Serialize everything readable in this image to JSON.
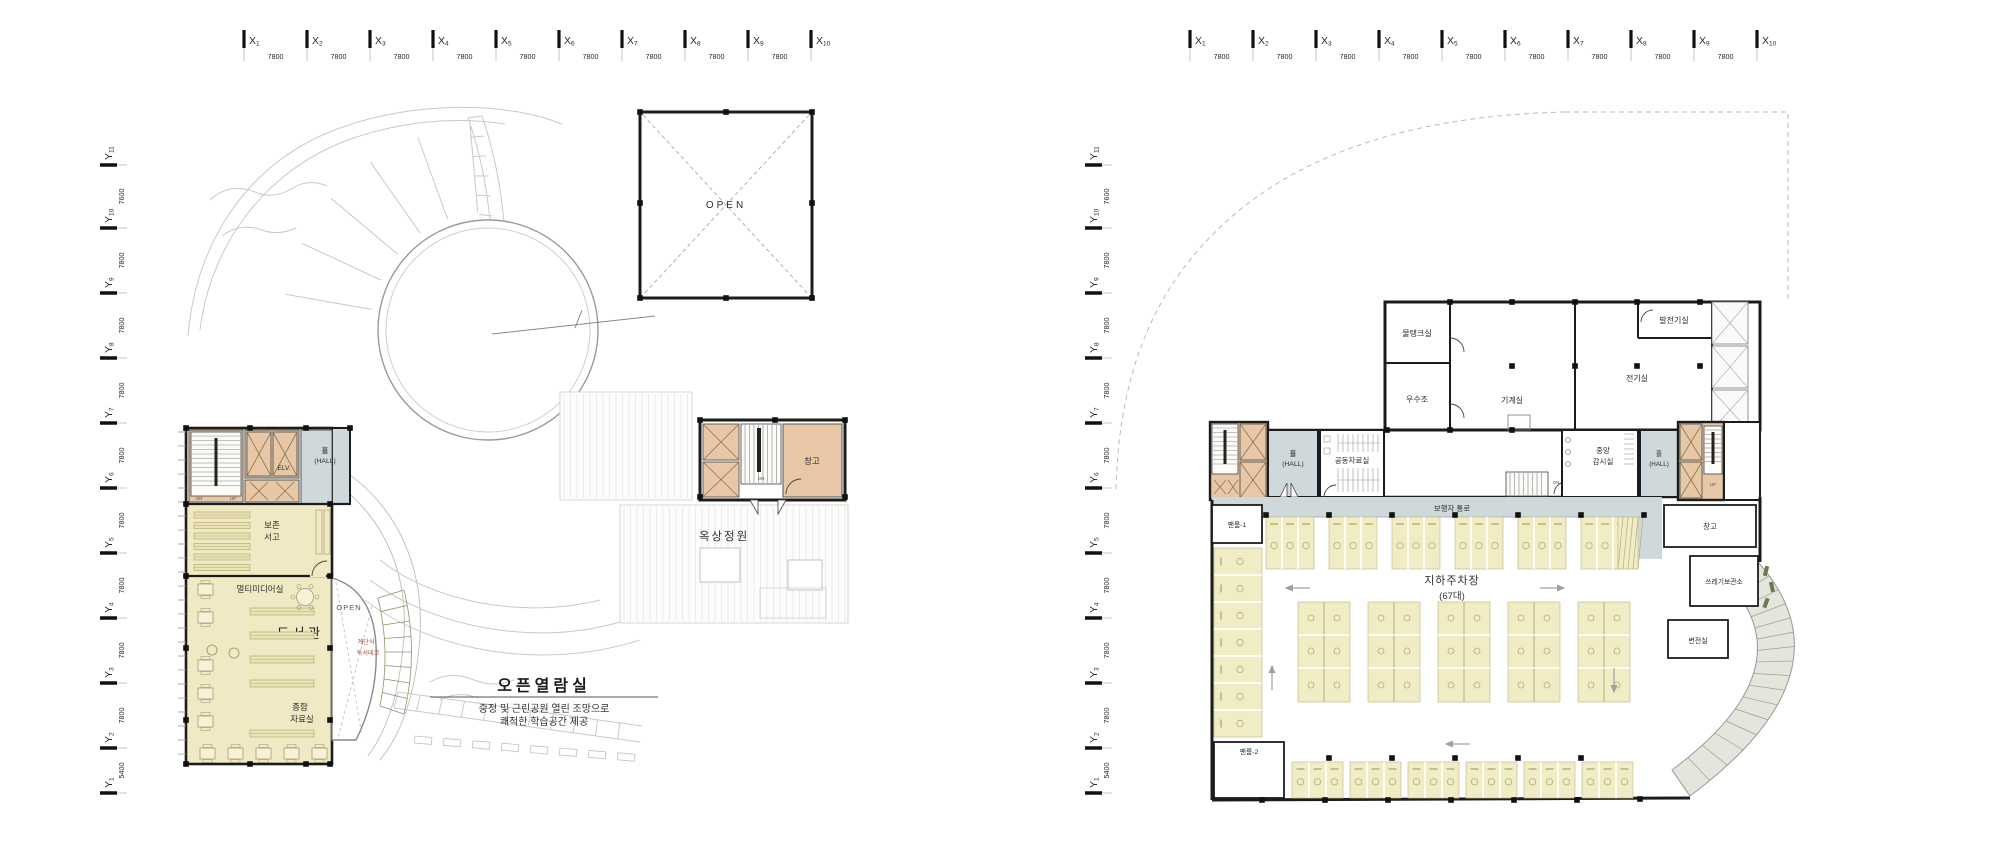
{
  "sheet": {
    "description": "Two Korean architectural floor plans side by side"
  },
  "colors": {
    "wall": "#1c1c1c",
    "core_fill": "#e7c7a5",
    "hall_fill": "#cfd8da",
    "room_yellow": "#efeac3",
    "stall_yellow": "#f0ecc6",
    "landscape_line": "#c9c9c9",
    "accent_text": "#9c4b32",
    "ramp_fill": "#e3e6dc"
  },
  "axes": {
    "x": {
      "base": "X",
      "numbers": [
        "1",
        "2",
        "3",
        "4",
        "5",
        "6",
        "7",
        "8",
        "9",
        "10"
      ],
      "spacing": "7800"
    },
    "y": {
      "base": "Y",
      "numbers": [
        "11",
        "10",
        "9",
        "8",
        "7",
        "6",
        "5",
        "4",
        "3",
        "2",
        "1"
      ],
      "spacings": [
        "7600",
        "7800",
        "7800",
        "7800",
        "7800",
        "7800",
        "7800",
        "7800",
        "7800",
        "5400"
      ]
    }
  },
  "glyphs": {
    "on": "ON",
    "up": "UP",
    "dn": "DN",
    "wheelchair": "♿"
  },
  "left_plan": {
    "open_court": "OPEN",
    "hall_line1": "홀",
    "hall_line2": "(HALL)",
    "elv": "ELV.",
    "archive_line1": "보존",
    "archive_line2": "서고",
    "multimedia": "멀티미디어실",
    "library": "도서관",
    "open_void": "OPEN",
    "stepped_line1": "계단식",
    "stepped_line2": "독서데크",
    "reference_line1": "종합",
    "reference_line2": "자료실",
    "storage": "창고",
    "roof_garden": "옥상정원",
    "callout": {
      "title": "오픈열람실",
      "desc1": "중정 및 근린공원 열린 조망으로",
      "desc2": "쾌적한 학습공간 제공"
    }
  },
  "right_plan": {
    "water_tank": "물탱크실",
    "rain_tank": "우수조",
    "machine_room": "기계실",
    "generator_room": "발전기실",
    "electric_room": "전기실",
    "hall_left_line1": "홀",
    "hall_left_line2": "(HALL)",
    "shared_archive": "공동자료실",
    "monitor_line1": "중앙",
    "monitor_line2": "감시실",
    "hall_right_line1": "홀",
    "hall_right_line2": "(HALL)",
    "corridor": "보행자 통로",
    "parking_line1": "지하주차장",
    "parking_line2": "(67대)",
    "fan_room_1": "팬룸-1",
    "fan_room_2": "팬룸-2",
    "storage": "창고",
    "trash_room": "쓰레기보관소",
    "substation": "변전실"
  }
}
